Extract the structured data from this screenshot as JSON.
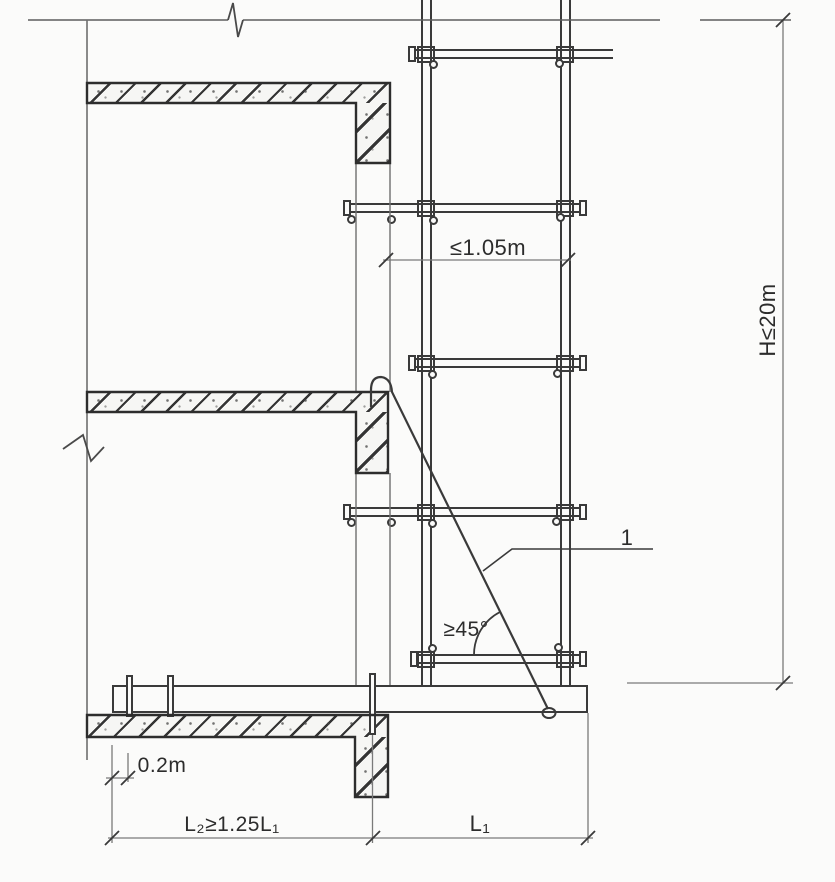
{
  "meta": {
    "description": "Cantilevered steel-beam scaffold elevation detail drawing",
    "callout_1_target": "diagonal steel tie rod"
  },
  "colors": {
    "background": "#fbfbfa",
    "structure_line": "#3a3a3a",
    "outline_dark": "#2d2d2d",
    "thin_line": "#6f6f6f",
    "dimension_line": "#7a7a7a",
    "text": "#2c2c2c"
  },
  "labels": {
    "bay_width": "≤1.05m",
    "scaffold_height": "H≤20m",
    "callout_1": "1",
    "tie_angle": "≥45°",
    "beam_end_offset": "0.2m",
    "anchored_length": "L₂≥1.25L₁",
    "cantilever_length": "L₁"
  }
}
